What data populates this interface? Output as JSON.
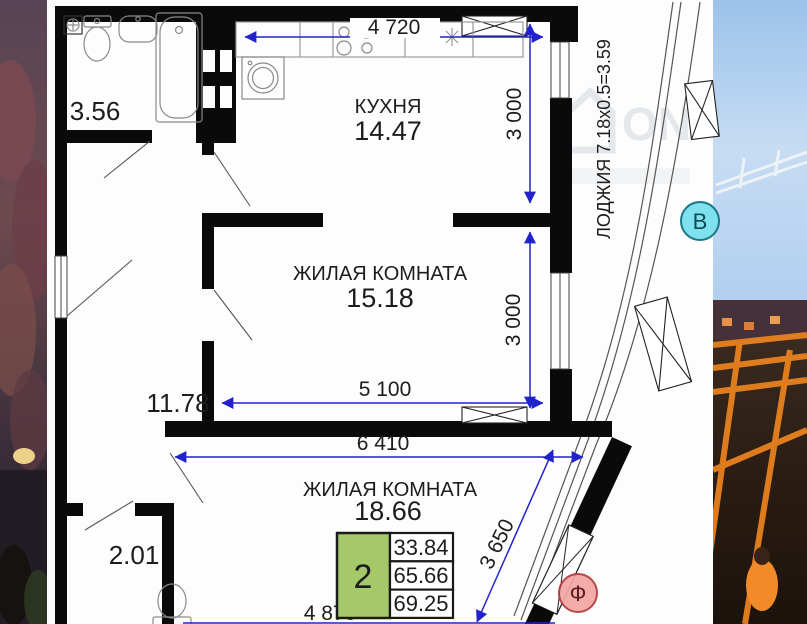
{
  "watermark": {
    "text": "ON"
  },
  "rooms": {
    "bathroom": {
      "area": "3.56"
    },
    "kitchen": {
      "name": "КУХНЯ",
      "area": "14.47"
    },
    "living1": {
      "name": "ЖИЛАЯ КОМНАТА",
      "area": "15.18"
    },
    "hall": {
      "area": "11.78"
    },
    "wc": {
      "area": "2.01"
    },
    "living2": {
      "name": "ЖИЛАЯ КОМНАТА",
      "area": "18.66"
    }
  },
  "loggia": {
    "label": "ЛОДЖИЯ 7.18x0.5=3.59"
  },
  "dimensions": {
    "kitchen_width": "4 720",
    "kitchen_depth": "3 000",
    "living1_depth": "3 000",
    "living1_width": "5 100",
    "living2_width": "6 410",
    "living2_diagonal": "3 650",
    "living2_bottom": "4 870"
  },
  "summary": {
    "rooms_count": "2",
    "row1": "33.84",
    "row2": "65.66",
    "row3": "69.25"
  },
  "markers": {
    "section_b": "В",
    "section_f": "Ф"
  },
  "colors": {
    "dimension_blue": "#2222cc",
    "summary_green": "#a5c968",
    "marker_b_fill": "#7fe0ee",
    "marker_b_stroke": "#1a7686",
    "marker_f_fill": "#f2a6a3",
    "marker_f_stroke": "#b03a3a"
  }
}
